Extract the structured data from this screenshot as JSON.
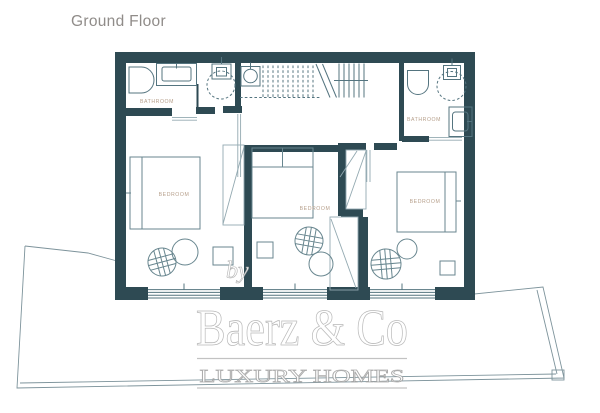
{
  "title": "Ground Floor",
  "rooms": {
    "bathroom_left": "BATHROOM",
    "bathroom_right": "BATHROOM",
    "bedroom_left": "BEDROOM",
    "bedroom_middle": "BEDROOM",
    "bedroom_right": "BEDROOM"
  },
  "watermark": {
    "by": "by",
    "brand": "Baerz & Co",
    "tagline": "LUXURY HOMES"
  },
  "colors": {
    "background": "#ffffff",
    "wall": "#2e4a53",
    "fixture_line": "#54747f",
    "furniture_line": "#68868f",
    "light_line": "#93a9b1",
    "terrace_line": "#7d939b",
    "room_label": "#b7a08c",
    "title_text": "#908c89",
    "watermark": "#b2b2b2"
  }
}
